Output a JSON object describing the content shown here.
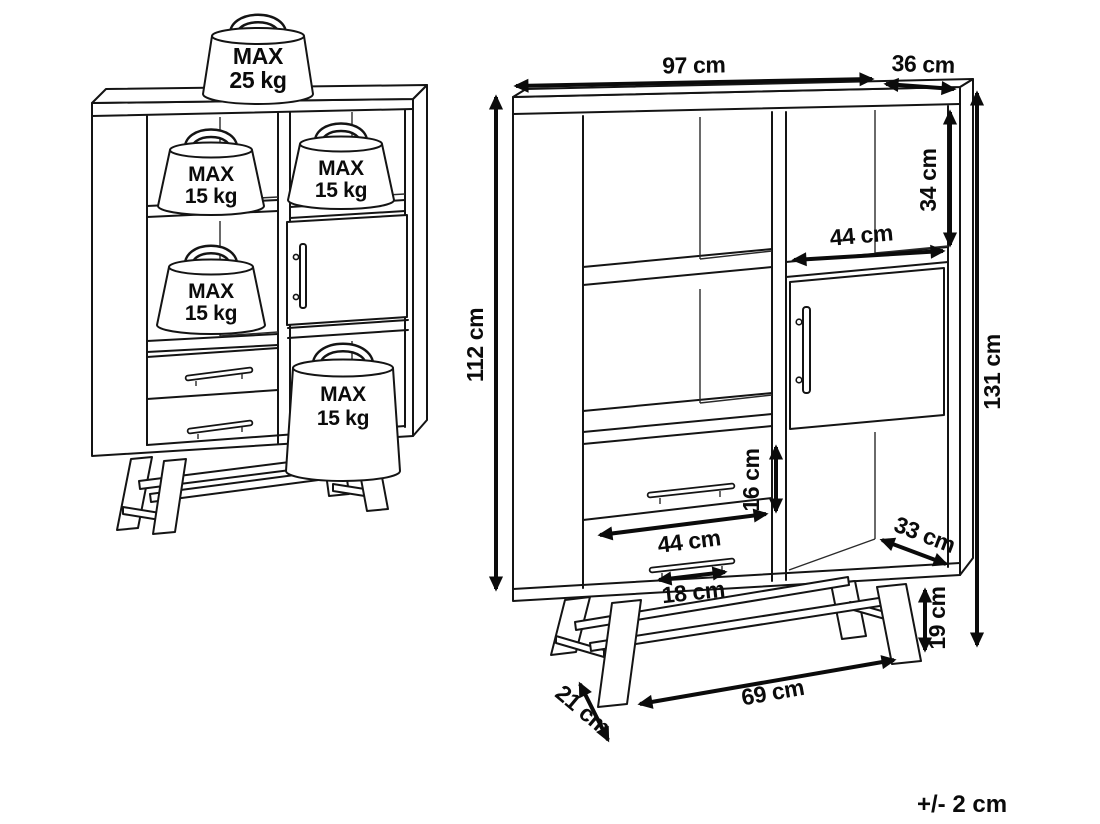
{
  "page": {
    "tolerance_note": "+/- 2 cm"
  },
  "weight_diagram": {
    "weights": [
      {
        "id": "top-surface",
        "line1": "MAX",
        "line2": "25 kg"
      },
      {
        "id": "upper-left-shelf",
        "line1": "MAX",
        "line2": "15 kg"
      },
      {
        "id": "upper-right-shelf",
        "line1": "MAX",
        "line2": "15 kg"
      },
      {
        "id": "middle-left-shelf",
        "line1": "MAX",
        "line2": "15 kg"
      },
      {
        "id": "lower-right-shelf",
        "line1": "MAX",
        "line2": "15 kg"
      }
    ]
  },
  "dimension_diagram": {
    "dimensions": {
      "total_width": "97 cm",
      "depth": "36 cm",
      "top_opening_height": "34 cm",
      "upper_opening_width": "44 cm",
      "body_height": "112 cm",
      "total_height": "131 cm",
      "drawer_height": "16 cm",
      "drawer_width": "44 cm",
      "drawer_handle_width": "18 cm",
      "bottom_opening_width": "33 cm",
      "leg_height": "19 cm",
      "leg_span_width": "69 cm",
      "leg_depth": "21 cm"
    }
  }
}
